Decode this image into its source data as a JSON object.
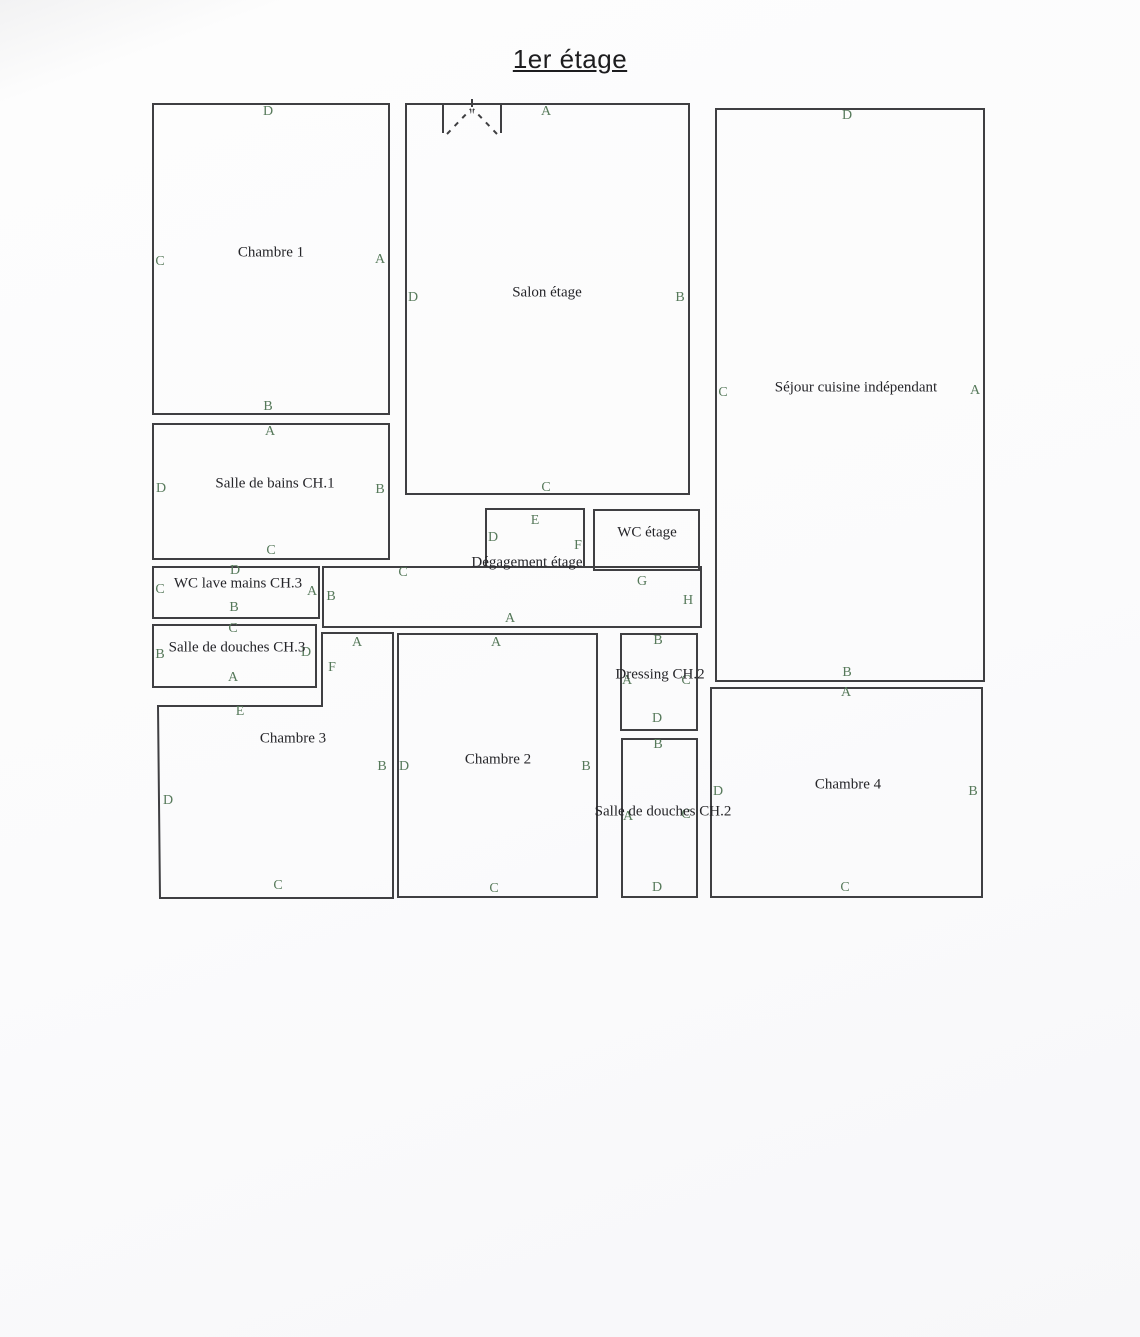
{
  "page": {
    "title": "1er étage"
  },
  "colors": {
    "wall": "#3f3f42",
    "letter_green": "#56795a",
    "room_text": "#252529",
    "page_bg": "#fbfbfc"
  },
  "plan": {
    "rooms": [
      {
        "id": "chambre-1",
        "type": "rect",
        "x": 152,
        "y": 103,
        "w": 238,
        "h": 312,
        "name": "Chambre 1",
        "name_at": [
          271,
          253
        ],
        "letters": [
          {
            "t": "D",
            "x": 268,
            "y": 112
          },
          {
            "t": "C",
            "x": 160,
            "y": 262
          },
          {
            "t": "A",
            "x": 380,
            "y": 260
          },
          {
            "t": "B",
            "x": 268,
            "y": 407
          }
        ]
      },
      {
        "id": "salon-etage",
        "type": "rect",
        "x": 405,
        "y": 103,
        "w": 285,
        "h": 392,
        "name": "Salon étage",
        "name_at": [
          547,
          293
        ],
        "letters": [
          {
            "t": "A",
            "x": 546,
            "y": 112
          },
          {
            "t": "D",
            "x": 413,
            "y": 298
          },
          {
            "t": "B",
            "x": 680,
            "y": 298
          },
          {
            "t": "C",
            "x": 546,
            "y": 488
          }
        ]
      },
      {
        "id": "sejour-cuisine-independant",
        "type": "rect",
        "x": 715,
        "y": 108,
        "w": 270,
        "h": 574,
        "name": "Séjour cuisine indépendant",
        "name_at": [
          856,
          388
        ],
        "letters": [
          {
            "t": "D",
            "x": 847,
            "y": 116
          },
          {
            "t": "C",
            "x": 723,
            "y": 393
          },
          {
            "t": "A",
            "x": 975,
            "y": 391
          },
          {
            "t": "B",
            "x": 847,
            "y": 673
          }
        ]
      },
      {
        "id": "salle-de-bains-ch1",
        "type": "rect",
        "x": 152,
        "y": 423,
        "w": 238,
        "h": 137,
        "name": "Salle de bains CH.1",
        "name_at": [
          275,
          484
        ],
        "letters": [
          {
            "t": "A",
            "x": 270,
            "y": 432
          },
          {
            "t": "D",
            "x": 161,
            "y": 489
          },
          {
            "t": "B",
            "x": 380,
            "y": 490
          },
          {
            "t": "C",
            "x": 271,
            "y": 551
          }
        ]
      },
      {
        "id": "wc-lave-mains-ch3",
        "type": "rect",
        "x": 152,
        "y": 566,
        "w": 168,
        "h": 53,
        "name": "WC lave mains CH.3",
        "name_at": [
          238,
          584
        ],
        "letters": [
          {
            "t": "D",
            "x": 235,
            "y": 571
          },
          {
            "t": "C",
            "x": 160,
            "y": 590
          },
          {
            "t": "A",
            "x": 312,
            "y": 592
          },
          {
            "t": "B",
            "x": 234,
            "y": 608
          }
        ]
      },
      {
        "id": "salle-de-douches-ch3",
        "type": "rect",
        "x": 152,
        "y": 624,
        "w": 165,
        "h": 64,
        "name": "Salle de douches CH.3",
        "name_at": [
          237,
          648
        ],
        "letters": [
          {
            "t": "C",
            "x": 233,
            "y": 629
          },
          {
            "t": "B",
            "x": 160,
            "y": 655
          },
          {
            "t": "D",
            "x": 306,
            "y": 653
          },
          {
            "t": "A",
            "x": 233,
            "y": 678
          }
        ]
      },
      {
        "id": "degagement-etage-notch",
        "type": "rect",
        "x": 485,
        "y": 508,
        "w": 100,
        "h": 58,
        "sides": "no-bottom",
        "name": null,
        "name_at": null,
        "letters": [
          {
            "t": "E",
            "x": 535,
            "y": 521
          },
          {
            "t": "D",
            "x": 493,
            "y": 538
          },
          {
            "t": "F",
            "x": 578,
            "y": 546
          }
        ]
      },
      {
        "id": "wc-etage",
        "type": "rect",
        "x": 593,
        "y": 509,
        "w": 107,
        "h": 62,
        "name": "WC étage",
        "name_at": [
          647,
          533
        ],
        "letters": []
      },
      {
        "id": "degagement-etage",
        "type": "rect",
        "x": 322,
        "y": 566,
        "w": 380,
        "h": 62,
        "name": "Dégagement étage",
        "name_at": [
          527,
          563
        ],
        "letters": [
          {
            "t": "C",
            "x": 403,
            "y": 573
          },
          {
            "t": "B",
            "x": 331,
            "y": 597
          },
          {
            "t": "G",
            "x": 642,
            "y": 582
          },
          {
            "t": "H",
            "x": 688,
            "y": 601
          },
          {
            "t": "A",
            "x": 510,
            "y": 619
          }
        ]
      },
      {
        "id": "chambre-3",
        "type": "poly",
        "points": [
          [
            158,
            706
          ],
          [
            322,
            706
          ],
          [
            322,
            633
          ],
          [
            393,
            633
          ],
          [
            393,
            898
          ],
          [
            160,
            898
          ]
        ],
        "name": "Chambre 3",
        "name_at": [
          293,
          739
        ],
        "letters": [
          {
            "t": "A",
            "x": 357,
            "y": 643
          },
          {
            "t": "F",
            "x": 332,
            "y": 668
          },
          {
            "t": "E",
            "x": 240,
            "y": 712
          },
          {
            "t": "B",
            "x": 382,
            "y": 767
          },
          {
            "t": "D",
            "x": 168,
            "y": 801
          },
          {
            "t": "C",
            "x": 278,
            "y": 886
          }
        ]
      },
      {
        "id": "chambre-2",
        "type": "rect",
        "x": 397,
        "y": 633,
        "w": 201,
        "h": 265,
        "name": "Chambre 2",
        "name_at": [
          498,
          760
        ],
        "letters": [
          {
            "t": "A",
            "x": 496,
            "y": 643
          },
          {
            "t": "D",
            "x": 404,
            "y": 767
          },
          {
            "t": "B",
            "x": 586,
            "y": 767
          },
          {
            "t": "C",
            "x": 494,
            "y": 889
          }
        ]
      },
      {
        "id": "dressing-ch2",
        "type": "rect",
        "x": 620,
        "y": 633,
        "w": 78,
        "h": 98,
        "name": "Dressing CH.2",
        "name_at": [
          660,
          675
        ],
        "letters": [
          {
            "t": "B",
            "x": 658,
            "y": 641
          },
          {
            "t": "A",
            "x": 627,
            "y": 681
          },
          {
            "t": "C",
            "x": 686,
            "y": 681
          },
          {
            "t": "D",
            "x": 657,
            "y": 719
          }
        ]
      },
      {
        "id": "salle-de-douches-ch2",
        "type": "rect",
        "x": 621,
        "y": 738,
        "w": 77,
        "h": 160,
        "name": "Salle de douches CH.2",
        "name_at": [
          663,
          812
        ],
        "letters": [
          {
            "t": "B",
            "x": 658,
            "y": 745
          },
          {
            "t": "A",
            "x": 628,
            "y": 817
          },
          {
            "t": "C",
            "x": 686,
            "y": 815
          },
          {
            "t": "D",
            "x": 657,
            "y": 888
          }
        ]
      },
      {
        "id": "chambre-4",
        "type": "rect",
        "x": 710,
        "y": 687,
        "w": 273,
        "h": 211,
        "name": "Chambre 4",
        "name_at": [
          848,
          785
        ],
        "letters": [
          {
            "t": "A",
            "x": 846,
            "y": 693
          },
          {
            "t": "D",
            "x": 718,
            "y": 792
          },
          {
            "t": "B",
            "x": 973,
            "y": 792
          },
          {
            "t": "C",
            "x": 845,
            "y": 888
          }
        ]
      }
    ],
    "door": {
      "name": "double-door-swing-icon",
      "jambs": [
        [
          [
            443,
            104
          ],
          [
            443,
            133
          ]
        ],
        [
          [
            501,
            104
          ],
          [
            501,
            133
          ]
        ]
      ],
      "dashes": [
        [
          [
            447,
            134
          ],
          [
            471,
            109
          ]
        ],
        [
          [
            497,
            134
          ],
          [
            473,
            109
          ]
        ]
      ],
      "tick": [
        [
          472,
          99
        ],
        [
          472,
          107
        ]
      ],
      "quote_mark": "\"",
      "quote_at": [
        472,
        119
      ]
    }
  }
}
